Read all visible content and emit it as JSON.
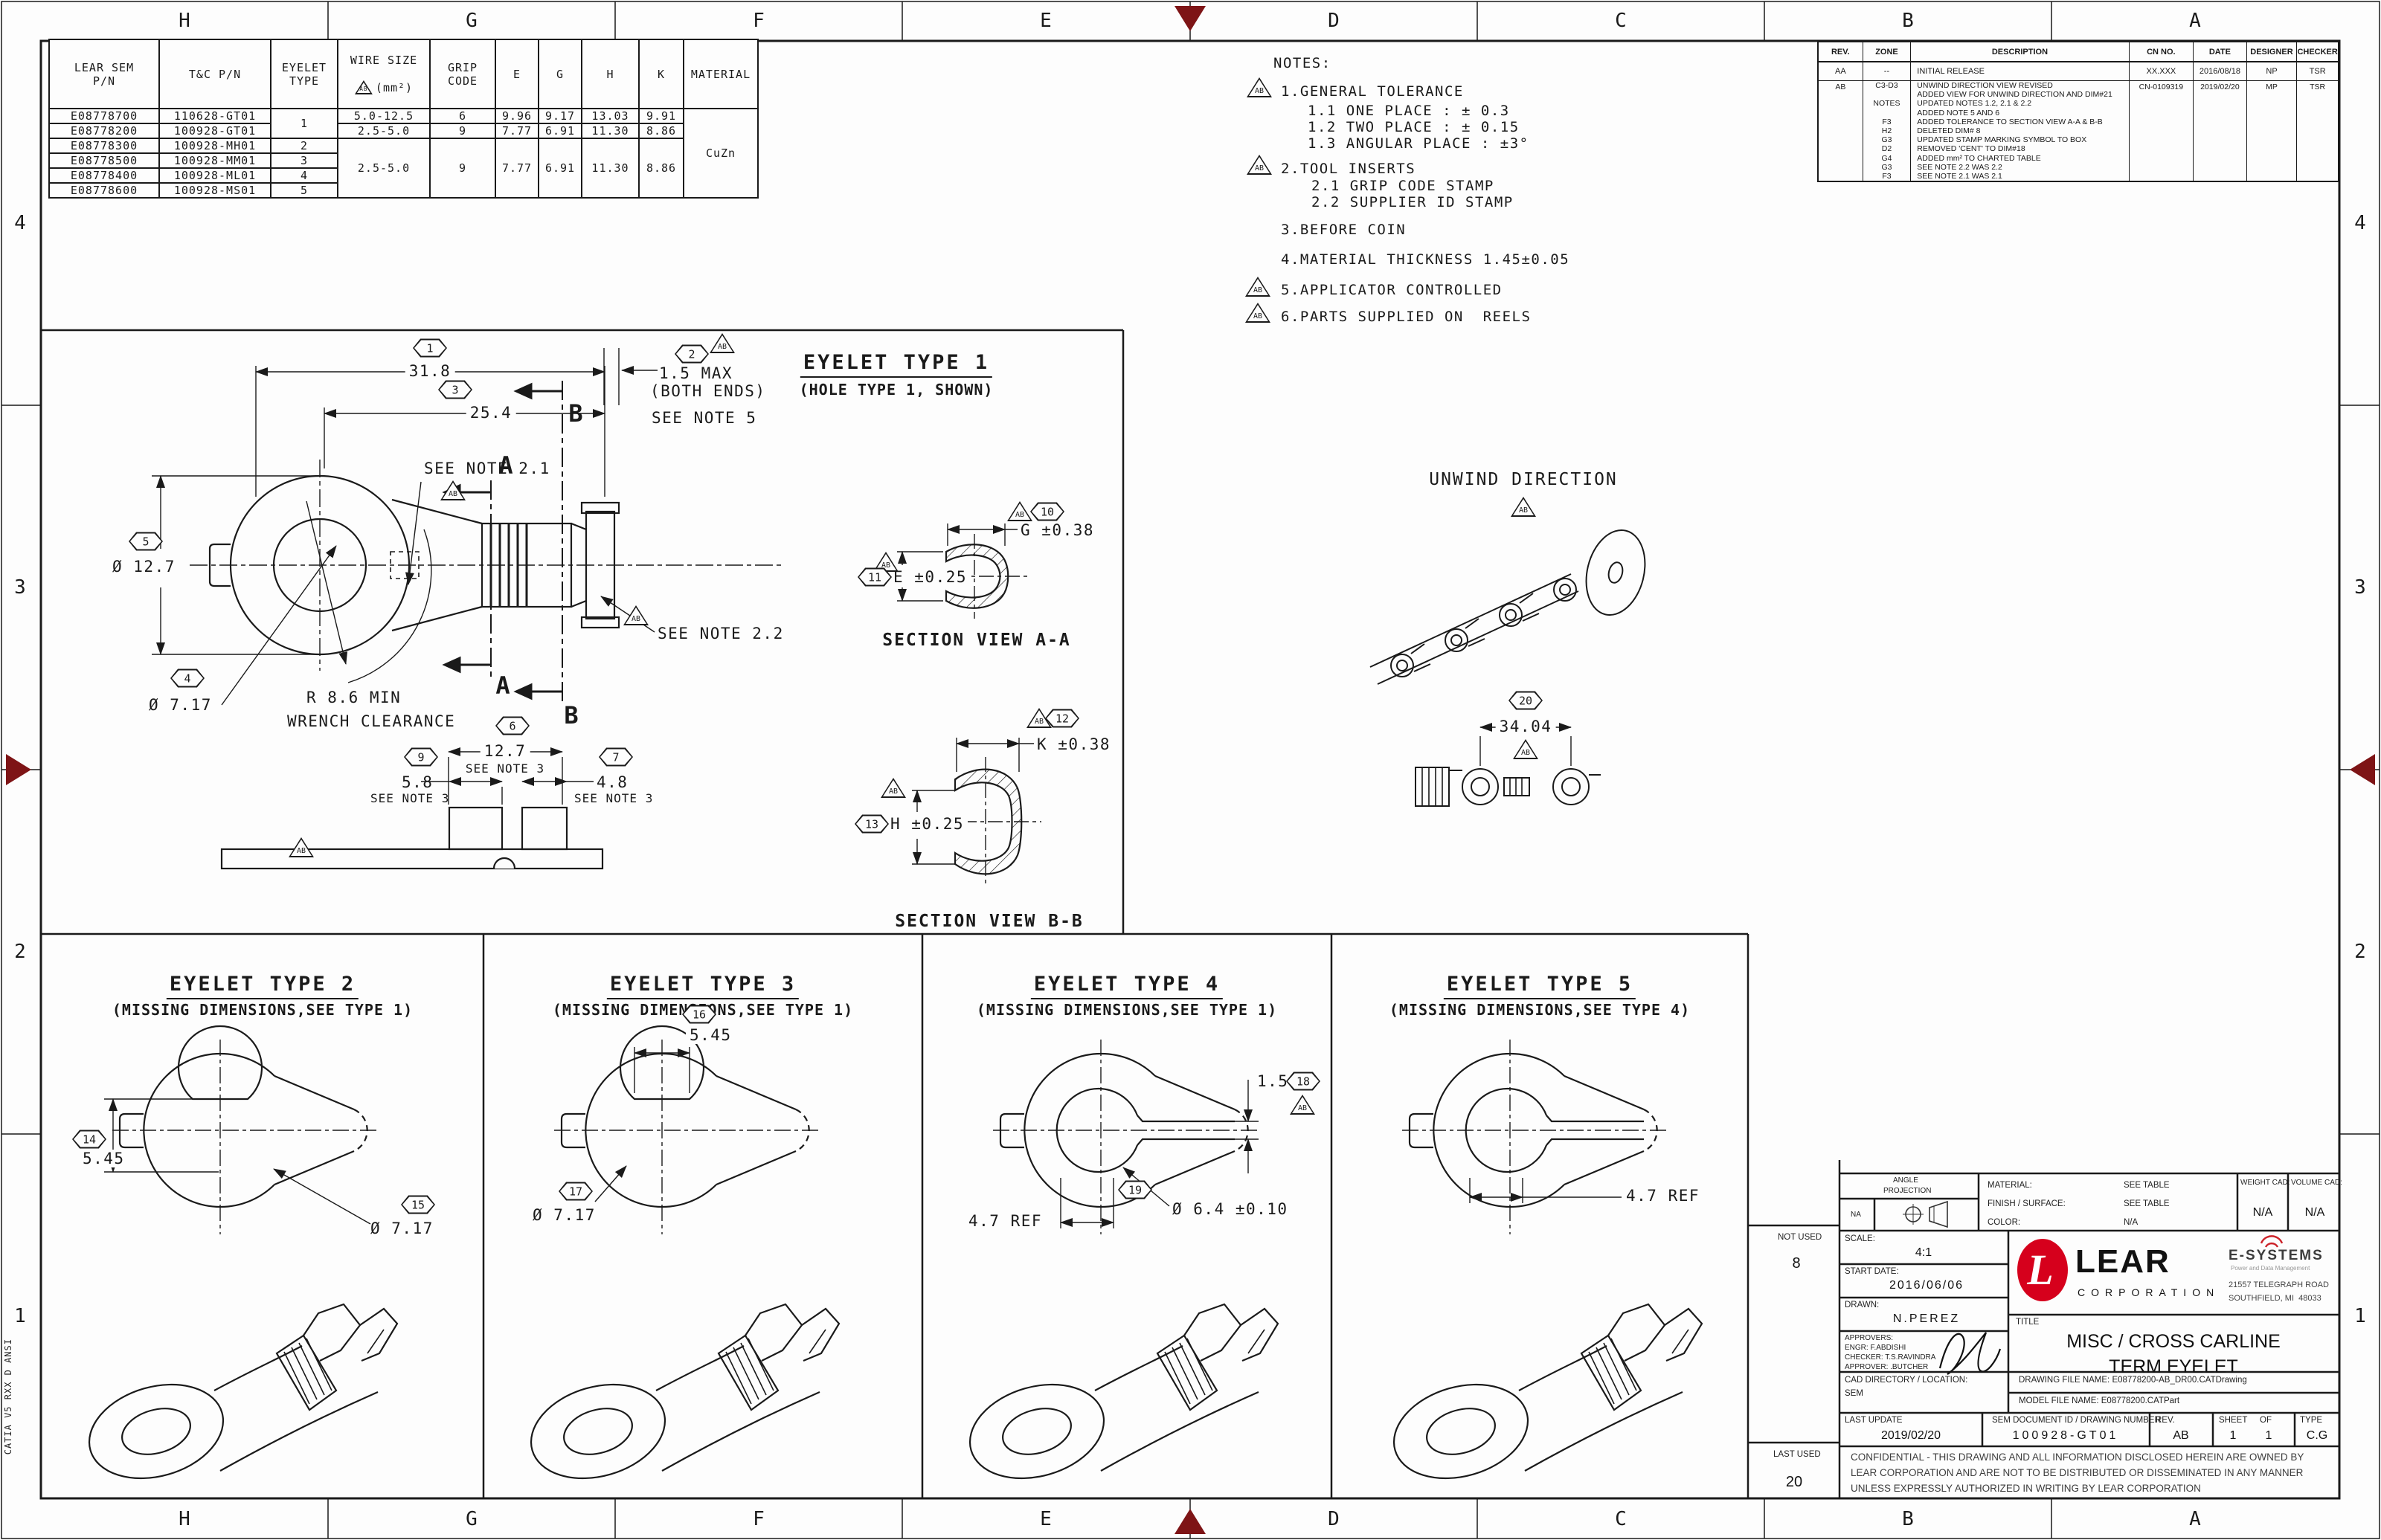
{
  "colors": {
    "marker": "#7e1416",
    "lear_red": "#d6001c",
    "line": "#1a1a1a"
  },
  "flag": "AB",
  "frame": {
    "cols": [
      "H",
      "G",
      "F",
      "E",
      "D",
      "C",
      "B",
      "A"
    ],
    "rows": [
      "4",
      "3",
      "2",
      "1"
    ],
    "catia": "CATIA V5 RXX D ANSI"
  },
  "part_table": {
    "h": {
      "pn": "LEAR SEM\nP/N",
      "tc": "T&C P/N",
      "type": "EYELET\nTYPE",
      "wire1": "WIRE SIZE",
      "wire2": "(mm²)",
      "grip": "GRIP\nCODE",
      "e": "E",
      "g": "G",
      "hh": "H",
      "k": "K",
      "mat": "MATERIAL"
    },
    "r": [
      {
        "pn": "E08778700",
        "tc": "110628-GT01",
        "wire": "5.0-12.5",
        "grip": "6",
        "e": "9.96",
        "g": "9.17",
        "h": "13.03",
        "k": "9.91"
      },
      {
        "pn": "E08778200",
        "tc": "100928-GT01",
        "wire": "2.5-5.0",
        "grip": "9",
        "e": "7.77",
        "g": "6.91",
        "h": "11.30",
        "k": "8.86"
      },
      {
        "pn": "E08778300",
        "tc": "100928-MH01",
        "type": "2"
      },
      {
        "pn": "E08778500",
        "tc": "100928-MM01",
        "type": "3"
      },
      {
        "pn": "E08778400",
        "tc": "100928-ML01",
        "type": "4"
      },
      {
        "pn": "E08778600",
        "tc": "100928-MS01",
        "type": "5"
      }
    ],
    "type12": "1",
    "m": {
      "wire": "2.5-5.0",
      "grip": "9",
      "e": "7.77",
      "g": "6.91",
      "h": "11.30",
      "k": "8.86"
    },
    "material": "CuZn"
  },
  "notes": {
    "title": "NOTES:",
    "n1": "1.GENERAL TOLERANCE",
    "n1_1": "1.1 ONE PLACE : ± 0.3",
    "n1_2": "1.2 TWO PLACE : ± 0.15",
    "n1_3": "1.3 ANGULAR PLACE : ±3°",
    "n2": "2.TOOL INSERTS",
    "n2_1": "2.1 GRIP CODE STAMP",
    "n2_2": "2.2 SUPPLIER ID STAMP",
    "n3": "3.BEFORE COIN",
    "n4": "4.MATERIAL THICKNESS 1.45±0.05",
    "n5": "5.APPLICATOR CONTROLLED",
    "n6": "6.PARTS SUPPLIED ON  REELS"
  },
  "rev": {
    "h": [
      "REV.",
      "ZONE",
      "DESCRIPTION",
      "CN NO.",
      "DATE",
      "DESIGNER",
      "CHECKER"
    ],
    "aa": {
      "rev": "AA",
      "zone": "--",
      "desc": "INITIAL RELEASE",
      "cn": "XX.XXX",
      "date": "2016/08/18",
      "des": "NP",
      "chk": "TSR"
    },
    "ab": {
      "rev": "AB",
      "cn": "CN-0109319",
      "date": "2019/02/20",
      "des": "MP",
      "chk": "TSR",
      "lines": [
        {
          "z": "C3-D3",
          "d": "UNWIND DIRECTION VIEW REVISED"
        },
        {
          "z": "",
          "d": "ADDED VIEW FOR UNWIND DIRECTION AND DIM#21"
        },
        {
          "z": "NOTES",
          "d": "UPDATED NOTES 1.2, 2.1 & 2.2"
        },
        {
          "z": "",
          "d": "ADDED NOTE 5 AND 6"
        },
        {
          "z": "F3",
          "d": "ADDED TOLERANCE TO SECTION VIEW A-A & B-B"
        },
        {
          "z": "H2",
          "d": "DELETED DIM# 8"
        },
        {
          "z": "G3",
          "d": "UPDATED STAMP MARKING SYMBOL TO BOX"
        },
        {
          "z": "D2",
          "d": "REMOVED 'CENT' TO DIM#18"
        },
        {
          "z": "G4",
          "d": "ADDED mm² TO CHARTED TABLE"
        },
        {
          "z": "G3",
          "d": "SEE NOTE 2.2 WAS 2.2"
        },
        {
          "z": "F3",
          "d": "SEE NOTE 2.1 WAS 2.1"
        }
      ]
    }
  },
  "type1": {
    "title": "EYELET TYPE 1",
    "subtitle": "(HOLE TYPE 1, SHOWN)",
    "d1": {
      "b": "1",
      "v": "31.8"
    },
    "d3": {
      "b": "3",
      "v": "25.4"
    },
    "d2": {
      "b": "2",
      "v1": "1.5 MAX",
      "v2": "(BOTH ENDS)",
      "note": "SEE NOTE 5"
    },
    "note21": "SEE NOTE 2.1",
    "note22": "SEE NOTE 2.2",
    "d5": {
      "b": "5",
      "v": "Ø 12.7"
    },
    "d4": {
      "b": "4",
      "v": "Ø 7.17"
    },
    "wrench1": "R 8.6 MIN",
    "wrench2": "WRENCH CLEARANCE",
    "a": "A",
    "bb": "B",
    "d6": {
      "b": "6",
      "v": "12.7",
      "note": "SEE NOTE 3"
    },
    "d9": {
      "b": "9",
      "v": "5.8",
      "note": "SEE NOTE 3"
    },
    "d7": {
      "b": "7",
      "v": "4.8",
      "note": "SEE NOTE 3"
    }
  },
  "sections": {
    "aa": {
      "label": "SECTION VIEW A-A",
      "g": {
        "b": "10",
        "v": "G ±0.38"
      },
      "e": {
        "b": "11",
        "v": "E ±0.25"
      }
    },
    "bb": {
      "label": "SECTION VIEW B-B",
      "k": {
        "b": "12",
        "v": "K ±0.38"
      },
      "h": {
        "b": "13",
        "v": "H ±0.25"
      }
    }
  },
  "unwind": {
    "label": "UNWIND DIRECTION",
    "d20": {
      "b": "20",
      "v": "34.04"
    }
  },
  "panels": [
    {
      "title": "EYELET TYPE 2",
      "subtitle": "(MISSING DIMENSIONS,SEE TYPE 1)",
      "d14": {
        "b": "14",
        "v": "5.45"
      },
      "d15": {
        "b": "15",
        "v": "Ø 7.17"
      }
    },
    {
      "title": "EYELET TYPE 3",
      "subtitle": "(MISSING DIMENSIONS,SEE TYPE 1)",
      "d16": {
        "b": "16",
        "v": "5.45"
      },
      "d17": {
        "b": "17",
        "v": "Ø 7.17"
      }
    },
    {
      "title": "EYELET TYPE 4",
      "subtitle": "(MISSING DIMENSIONS,SEE TYPE 1)",
      "d18": {
        "b": "18",
        "v": "1.5"
      },
      "d19": {
        "b": "19",
        "v": "Ø 6.4 ±0.10"
      },
      "ref": "4.7 REF"
    },
    {
      "title": "EYELET TYPE 5",
      "subtitle": "(MISSING DIMENSIONS,SEE TYPE 4)",
      "ref": "4.7 REF"
    }
  ],
  "tb": {
    "not_used": "NOT USED",
    "not_used_val": "8",
    "last_used": "LAST USED",
    "last_used_val": "20",
    "angle1": "ANGLE",
    "angle2": "PROJECTION",
    "angle_na": "NA",
    "material_label": "MATERIAL:",
    "material_val": "SEE TABLE",
    "finish_label": "FINISH / SURFACE:",
    "finish_val": "SEE TABLE",
    "color_label": "COLOR:",
    "color_val": "N/A",
    "weight_label": "WEIGHT CAD:",
    "weight_val": "N/A",
    "volume_label": "VOLUME CAD:",
    "volume_val": "N/A",
    "scale_label": "SCALE:",
    "scale_val": "4:1",
    "start_label": "START DATE:",
    "start_val": "2016/06/06",
    "drawn_label": "DRAWN:",
    "drawn_val": "N.PEREZ",
    "approvers": "APPROVERS:",
    "engr": "ENGR: F.ABDISHI",
    "checker": "CHECKER: T.S.RAVINDRA",
    "approver": "APPROVER: .BUTCHER",
    "logo_l": "L",
    "logo_lear": "LEAR",
    "logo_corp": "CORPORATION",
    "esys": "E-SYSTEMS",
    "esys_sub": "Power and Data Management",
    "esys_addr1": "21557 TELEGRAPH ROAD",
    "esys_addr2": "SOUTHFIELD, MI  48033",
    "title_label": "TITLE",
    "title1": "MISC / CROSS CARLINE",
    "title2": "TERM EYELET",
    "cad_label": "CAD DIRECTORY / LOCATION:",
    "cad_val": "SEM",
    "drawing_file": "DRAWING FILE NAME: E08778200-AB_DR00.CATDrawing",
    "model_file": "MODEL FILE NAME: E08778200.CATPart",
    "last_update_label": "LAST UPDATE",
    "last_update_val": "2019/02/20",
    "doc_label": "SEM DOCUMENT ID / DRAWING NUMBER",
    "doc_val": "100928-GT01",
    "rev_label": "REV.",
    "rev_val": "AB",
    "sheet_label": "SHEET",
    "of_label": "OF",
    "sheet_val": "1",
    "of_val": "1",
    "type_label": "TYPE",
    "type_val": "C.G",
    "conf1": "CONFIDENTIAL - THIS DRAWING AND ALL INFORMATION DISCLOSED HEREIN ARE OWNED BY",
    "conf2": "LEAR CORPORATION AND ARE NOT TO BE DISTRIBUTED OR DISSEMINATED IN ANY MANNER",
    "conf3": "UNLESS EXPRESSLY AUTHORIZED IN WRITING BY LEAR CORPORATION"
  }
}
